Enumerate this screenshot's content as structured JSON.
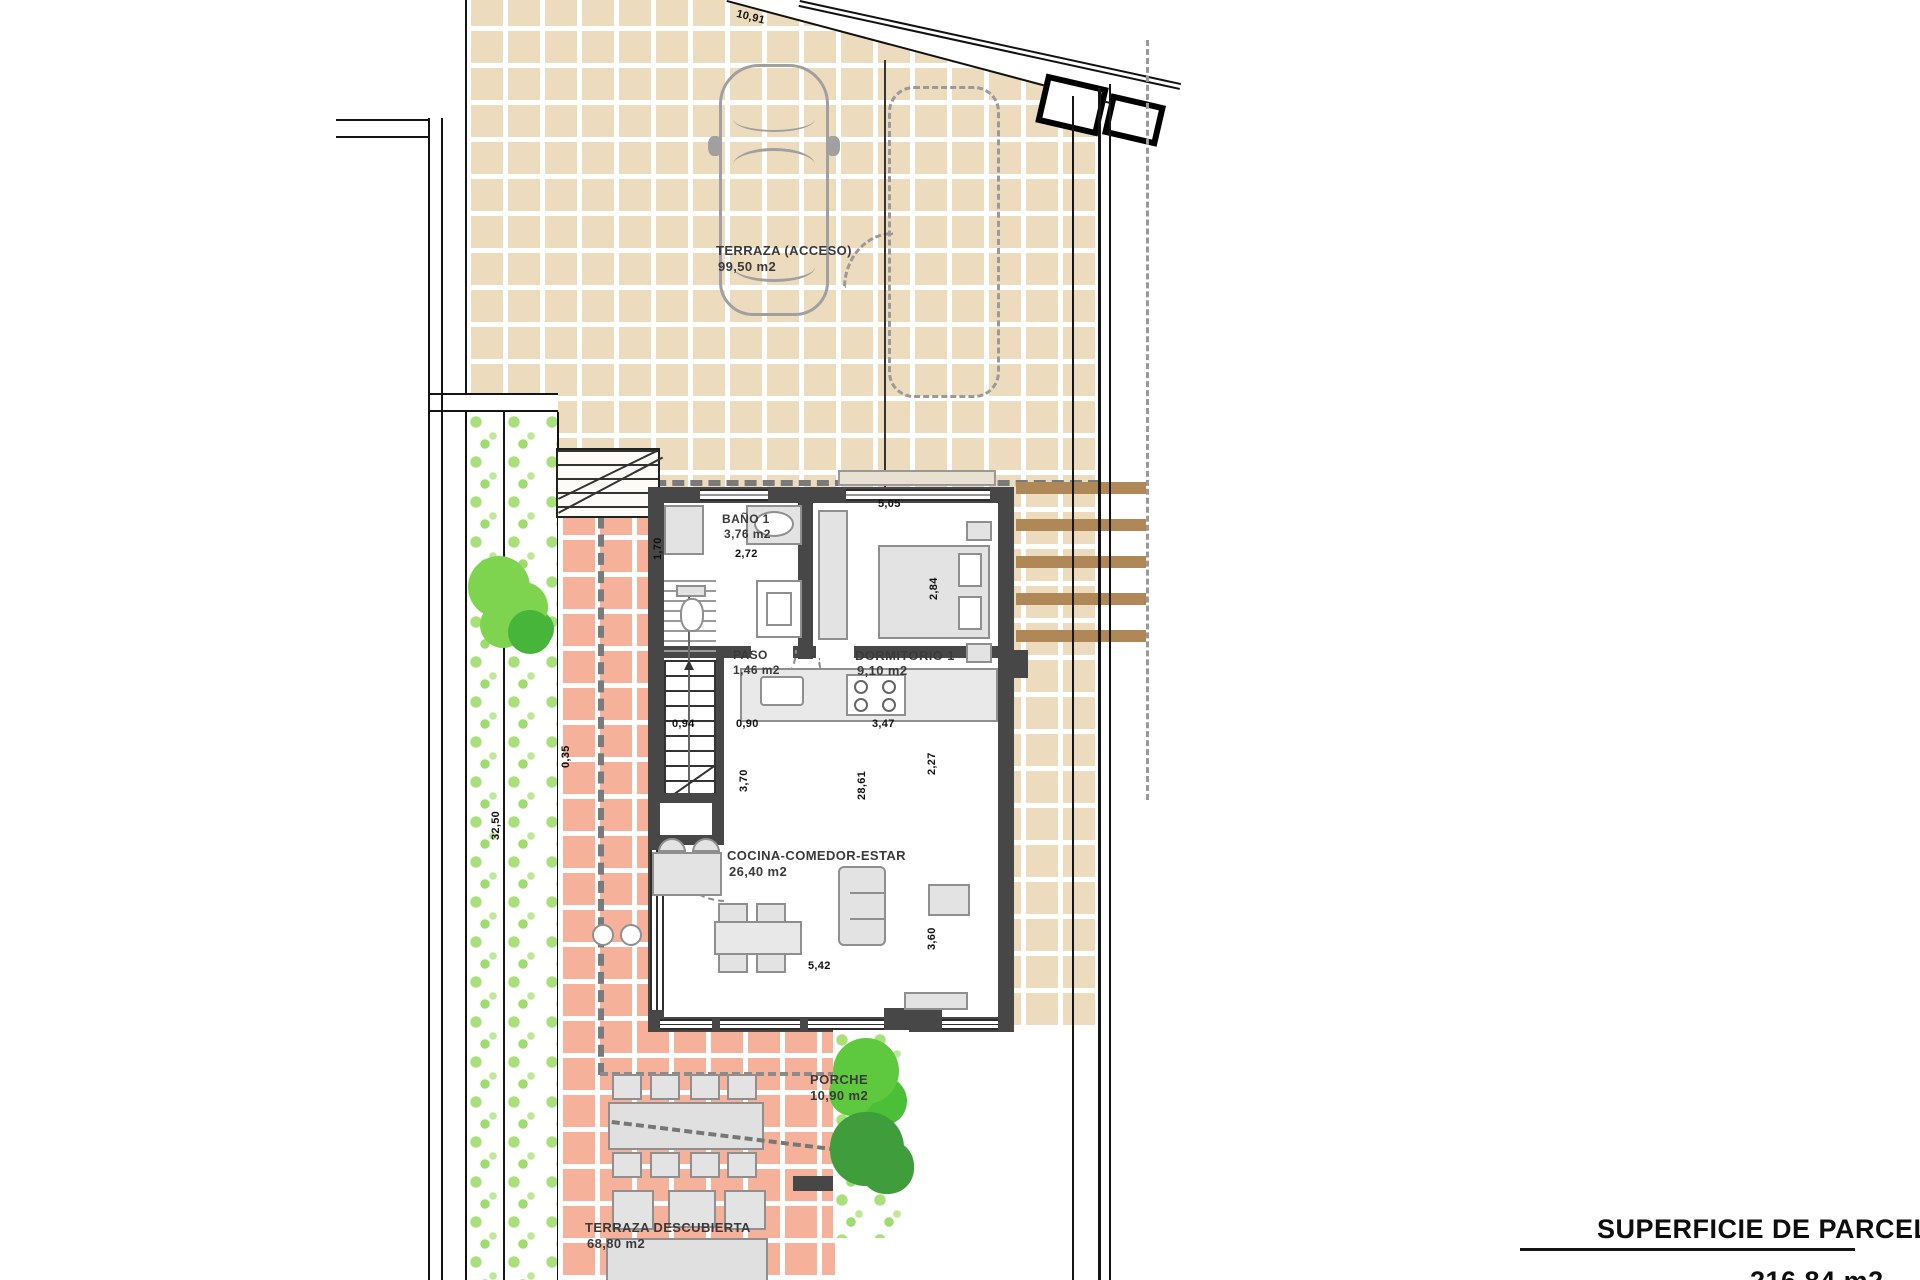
{
  "plan": {
    "title": "SUPERFICIE DE PARCELA",
    "parcel_area": "216,84 m2",
    "rooms": {
      "terraza_acceso": {
        "name": "TERRAZA (ACCESO)",
        "area": "99,50 m2"
      },
      "bano1": {
        "name": "BAÑO 1",
        "area": "3,76 m2"
      },
      "dormitorio1": {
        "name": "DORMITORIO 1",
        "area": "9,10 m2"
      },
      "paso": {
        "name": "PASO",
        "area": "1,46 m2"
      },
      "cocina": {
        "name": "COCINA-COMEDOR-ESTAR",
        "area": "26,40 m2"
      },
      "porche": {
        "name": "PORCHE",
        "area": "10,90 m2"
      },
      "terraza_descubierta": {
        "name": "TERRAZA DESCUBIERTA",
        "area": "68,80 m2"
      }
    },
    "dimensions": {
      "top_boundary": "10,91",
      "dorm_width": "5,05",
      "dorm_depth": "2,84",
      "bath_width": "2,72",
      "bath_depth": "1,70",
      "stair_width": "0,94",
      "pass_width": "0,90",
      "kitchen_width": "3,47",
      "kitchen_depth": "2,27",
      "stair_length": "3,70",
      "living_width": "5,42",
      "living_depth": "3,60",
      "side_right": "28,61",
      "side_left": "32,50",
      "step_width": "0,35"
    },
    "colors": {
      "terrace_tile": "#ecdbbd",
      "patio_tile": "#f6b19a",
      "garden_dot": "#a9e07c",
      "wall": "#474747",
      "pergola_wood": "#b08756"
    }
  }
}
